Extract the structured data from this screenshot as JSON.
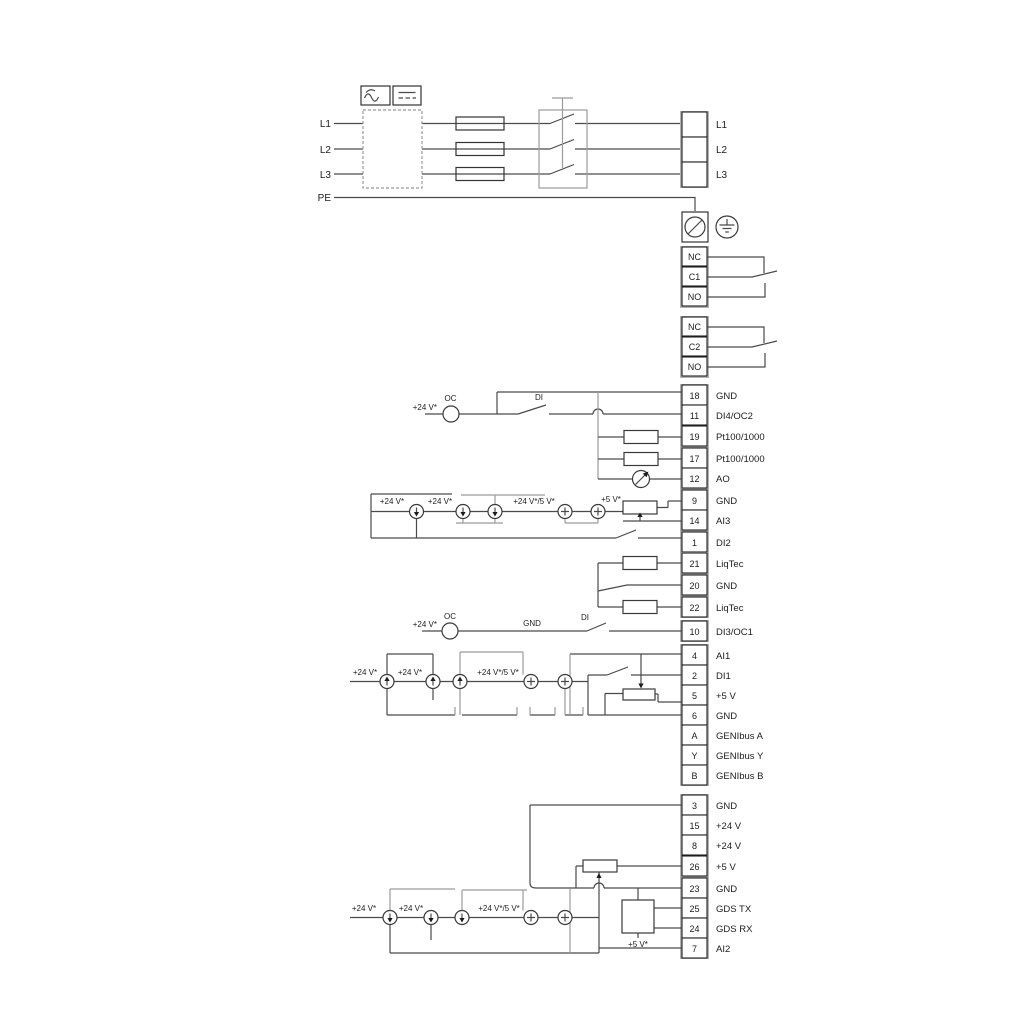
{
  "power": {
    "inputs": [
      "L1",
      "L2",
      "L3",
      "PE"
    ],
    "outputs": [
      "L1",
      "L2",
      "L3"
    ]
  },
  "relays": {
    "r1": [
      "NC",
      "C1",
      "NO"
    ],
    "r2": [
      "NC",
      "C2",
      "NO"
    ]
  },
  "groups": {
    "a": [
      {
        "t": "18",
        "l": "GND"
      },
      {
        "t": "11",
        "l": "DI4/OC2"
      },
      {
        "t": "19",
        "l": "Pt100/1000"
      },
      {
        "t": "17",
        "l": "Pt100/1000"
      },
      {
        "t": "12",
        "l": "AO"
      },
      {
        "t": "9",
        "l": "GND"
      },
      {
        "t": "14",
        "l": "AI3"
      },
      {
        "t": "1",
        "l": "DI2"
      }
    ],
    "liq": [
      {
        "t": "21",
        "l": "LiqTec"
      },
      {
        "t": "20",
        "l": "GND"
      },
      {
        "t": "22",
        "l": "LiqTec"
      }
    ],
    "r10": {
      "t": "10",
      "l": "DI3/OC1"
    },
    "b": [
      {
        "t": "4",
        "l": "AI1"
      },
      {
        "t": "2",
        "l": "DI1"
      },
      {
        "t": "5",
        "l": "+5 V"
      },
      {
        "t": "6",
        "l": "GND"
      },
      {
        "t": "A",
        "l": "GENIbus A"
      },
      {
        "t": "Y",
        "l": "GENIbus Y"
      },
      {
        "t": "B",
        "l": "GENIbus B"
      }
    ],
    "c": [
      {
        "t": "3",
        "l": "GND"
      },
      {
        "t": "15",
        "l": "+24 V"
      },
      {
        "t": "8",
        "l": "+24 V"
      },
      {
        "t": "26",
        "l": "+5 V"
      },
      {
        "t": "23",
        "l": "GND"
      },
      {
        "t": "25",
        "l": "GDS TX"
      },
      {
        "t": "24",
        "l": "GDS RX"
      },
      {
        "t": "7",
        "l": "AI2"
      }
    ]
  },
  "sym": {
    "p24": "+24 V*",
    "p245": "+24 V*/5 V*",
    "p5": "+5 V*",
    "oc": "OC",
    "di": "DI",
    "gnd": "GND"
  },
  "colors": {
    "wire": "#4a4a4a",
    "wire_light": "#9b9b9b",
    "text": "#1c1c1c"
  }
}
